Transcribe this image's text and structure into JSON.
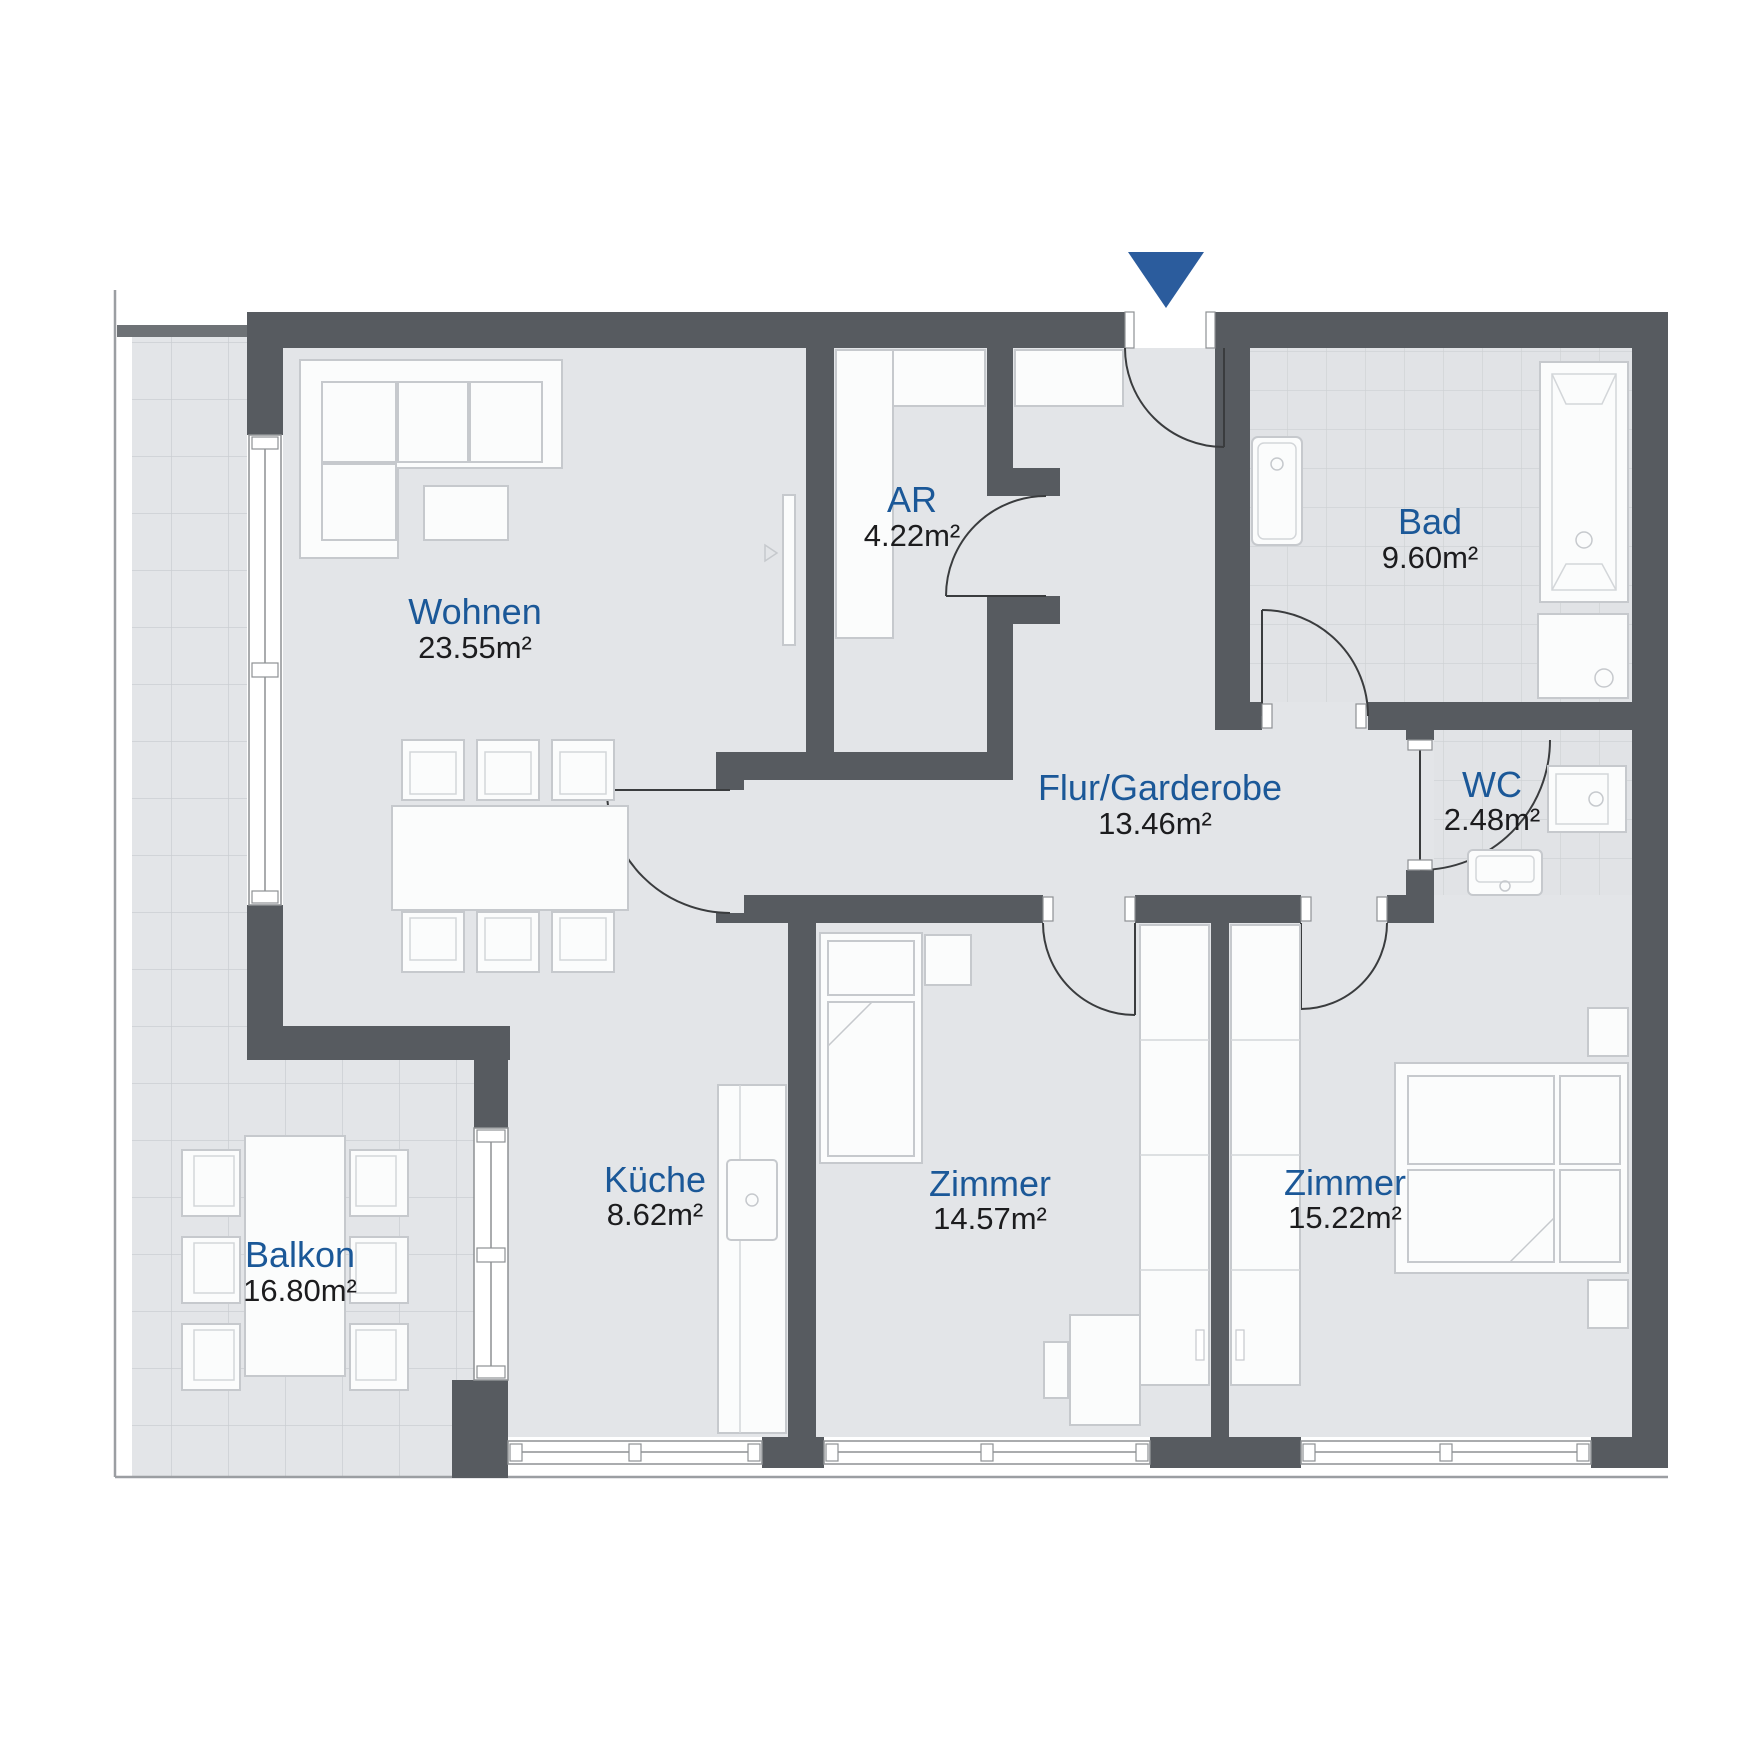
{
  "plan": {
    "type": "apartment-floor-plan",
    "entrance_marker_icon": "triangle-down-icon",
    "colors": {
      "wall": "#575b60",
      "floor": "#e3e5e8",
      "room_label": "#1b5898",
      "area_label": "#1c1c1e",
      "entrance_marker": "#2b5c9d",
      "furniture": "#fbfcfc"
    }
  },
  "rooms": [
    {
      "id": "wohnen",
      "name": "Wohnen",
      "area": "23.55m²"
    },
    {
      "id": "ar",
      "name": "AR",
      "area": "4.22m²"
    },
    {
      "id": "bad",
      "name": "Bad",
      "area": "9.60m²"
    },
    {
      "id": "flur",
      "name": "Flur/Garderobe",
      "area": "13.46m²"
    },
    {
      "id": "wc",
      "name": "WC",
      "area": "2.48m²"
    },
    {
      "id": "kueche",
      "name": "Küche",
      "area": "8.62m²"
    },
    {
      "id": "zimmer1",
      "name": "Zimmer",
      "area": "14.57m²"
    },
    {
      "id": "zimmer2",
      "name": "Zimmer",
      "area": "15.22m²"
    },
    {
      "id": "balkon",
      "name": "Balkon",
      "area": "16.80m²"
    }
  ]
}
